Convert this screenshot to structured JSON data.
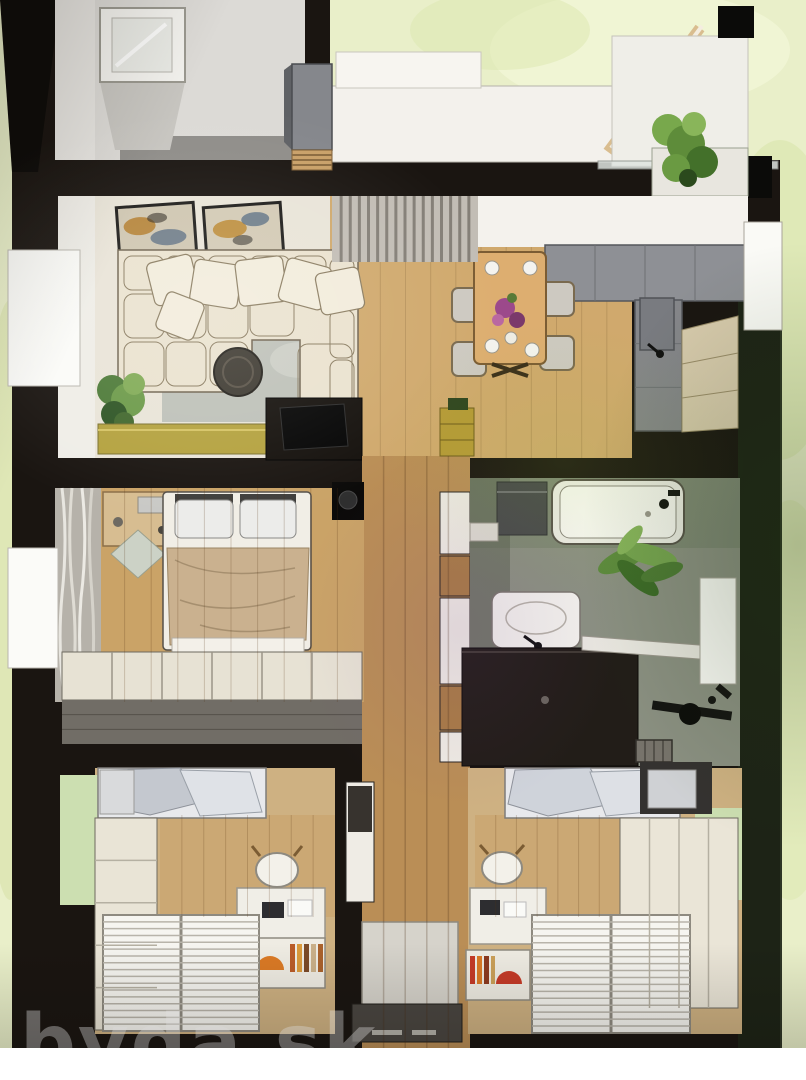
{
  "watermark": {
    "text": "byda.sk"
  },
  "colors": {
    "page_white": "#ffffff",
    "grass": "#e9efca",
    "grass_shade": "#d8e4ab",
    "wall": "#1a1511",
    "wall_green_dark": "#1d2517",
    "floor_cream": "#e9e4d8",
    "wood_floor": "#cfa96f",
    "wood_hall": "#b98e58",
    "wood_bedroom": "#c9a369",
    "laminate": "#cdb183",
    "sofa": "#eae2d0",
    "pillow": "#f2ecdc",
    "rug": "#b7bcb4",
    "sideboard_olive": "#b3a242",
    "counter_gray": "#8e9095",
    "cabinet_beige": "#d8cbae",
    "table_wood": "#dcae72",
    "blanket_tan": "#c9b190",
    "bed_white": "#f1eee6",
    "wardrobe_cream": "#e7e2d4",
    "curtain_gray": "#c2bdb5",
    "tile_green": "#8b9082",
    "vanity_dark": "#221d18",
    "tub_white": "#eeede7",
    "plant_green": "#5f8c3c",
    "blinds_white": "#f6f5f0",
    "wall_green_pale": "#ccdfb2",
    "accent_orange": "#d97a28",
    "accent_red": "#c23b28",
    "door_gray": "#4a4641",
    "watermark": "#ffffff"
  },
  "scene": {
    "view": "top-down 3d render",
    "rooms": [
      {
        "id": "entrance-hall",
        "features": [
          "skylight",
          "entry-cabinet",
          "wood-bench",
          "white-path",
          "pergola-beam"
        ]
      },
      {
        "id": "terrace",
        "features": [
          "black-column-caps",
          "glass-railing",
          "planter-with-plants"
        ]
      },
      {
        "id": "living-room",
        "features": [
          "two-wall-art-frames",
          "corner-sofa",
          "throw-pillows",
          "rug",
          "round-coffee-table",
          "potted-plant",
          "olive-sideboard",
          "tv-console",
          "curtain-wall"
        ]
      },
      {
        "id": "dining-area",
        "features": [
          "wood-table",
          "four-chairs",
          "flower-vase",
          "tableware"
        ]
      },
      {
        "id": "kitchen",
        "features": [
          "l-shaped-gray-counter",
          "sink",
          "tall-beige-cabinets",
          "window"
        ]
      },
      {
        "id": "hallway",
        "features": [
          "wood-plank-floor",
          "storage-cabinets",
          "brass-shelf",
          "tall-cabinet",
          "door-mat",
          "front-door"
        ]
      },
      {
        "id": "master-bedroom",
        "features": [
          "double-bed",
          "two-pillows",
          "tan-blanket",
          "dressing-table",
          "window-curtains",
          "diamond-rug",
          "cream-wardrobe",
          "wall-ac-unit"
        ]
      },
      {
        "id": "bathroom",
        "features": [
          "bathtub",
          "washing-machine",
          "sink-on-counter",
          "dark-vanity",
          "potted-plant",
          "window",
          "shower-fixture",
          "floor-drain",
          "white-bench"
        ]
      },
      {
        "id": "kids-bedroom-left",
        "features": [
          "bed-gray-blanket",
          "green-wall",
          "wardrobe",
          "desk",
          "chair",
          "bookshelf-orange-arch",
          "window-blinds"
        ]
      },
      {
        "id": "kids-bedroom-right",
        "features": [
          "bed-gray-blanket",
          "dark-headboard",
          "green-wall",
          "wardrobe",
          "desk",
          "chair",
          "bookshelf-red-arch",
          "window-blinds"
        ]
      }
    ]
  }
}
